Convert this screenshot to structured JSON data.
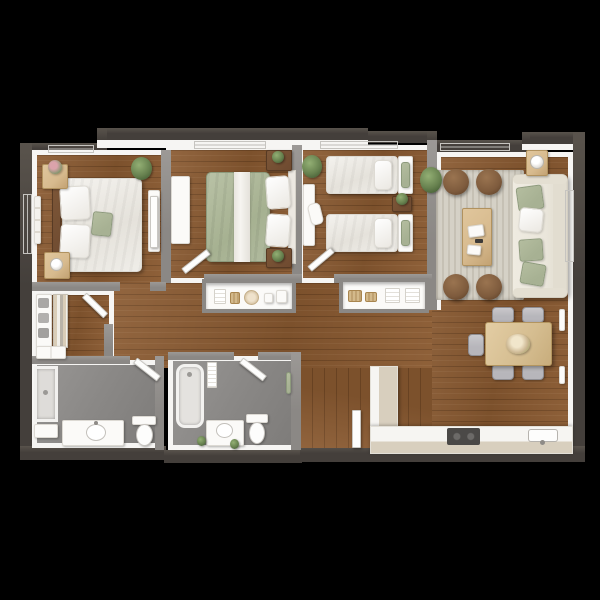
{
  "scene": {
    "type": "3d-apartment-floor-plan-render",
    "view": "top-down",
    "background": "#000000"
  },
  "palette": {
    "background": "#000000",
    "wall_exterior": "#443f3b",
    "wall_interior": "#8b8885",
    "wall_face": "#f6f5f3",
    "floor_wood": "#8a5a31",
    "floor_tile": "#8d8b89",
    "rug": "#d5d1c6",
    "sofa": "#eae6db",
    "sage": "#a7b193",
    "wood_light": "#d7ba8e",
    "wood_dark": "#6e4a30",
    "white_furniture": "#fbfaf8",
    "counter": "#d8cfbe",
    "appliance": "#4b4947",
    "ottoman": "#7e5b3d",
    "plant": "#67814f",
    "chair_gray": "#b7b6bb",
    "door_white": "#fdfdfc"
  },
  "rooms": [
    {
      "name": "bedroom-1",
      "floor": "wood",
      "furniture": [
        "double-bed",
        "headboard",
        "pillows",
        "sage-throw-pillow",
        "nightstand-with-flowers",
        "nightstand-with-lamp",
        "white-dresser",
        "potted-plant",
        "leaning-wall-art",
        "door"
      ]
    },
    {
      "name": "bedroom-2",
      "floor": "wood",
      "furniture": [
        "double-bed-sage-duvet",
        "white-bed-runner",
        "stacked-pillows",
        "dark-nightstand-with-plant-x2",
        "dresser",
        "window",
        "door"
      ]
    },
    {
      "name": "bedroom-3",
      "floor": "wood",
      "furniture": [
        "twin-bed-x2",
        "sage-headboard-cushions",
        "shared-dark-nightstand-with-plant",
        "desk",
        "desk-chair",
        "potted-plant",
        "door"
      ]
    },
    {
      "name": "living-room",
      "floor": "wood",
      "furniture": [
        "area-rug",
        "sofa-with-pillows",
        "coffee-table-with-books",
        "round-leather-ottoman-x4",
        "side-table-with-lamp",
        "potted-plant",
        "windows"
      ]
    },
    {
      "name": "dining-area",
      "floor": "wood",
      "furniture": [
        "dining-table",
        "centerpiece-flowers",
        "upholstered-chair-x5",
        "wall-art-x2"
      ]
    },
    {
      "name": "kitchen",
      "floor": "wood",
      "furniture": [
        "l-shaped-counter",
        "cooktop",
        "sink"
      ]
    },
    {
      "name": "hallway",
      "floor": "wood",
      "furniture": [
        "shelf-niche-dishes",
        "shelf-niche-linens-baskets"
      ]
    },
    {
      "name": "entry",
      "floor": "wood",
      "furniture": [
        "front-door"
      ]
    },
    {
      "name": "walk-in-closet",
      "floor": "wood",
      "furniture": [
        "shelving-with-folded-clothes",
        "hanging-clothes-rod",
        "drawer-unit",
        "door"
      ]
    },
    {
      "name": "bathroom-1",
      "floor": "tile",
      "furniture": [
        "shower",
        "vanity-with-sink",
        "toilet",
        "wall-niche",
        "door"
      ]
    },
    {
      "name": "bathroom-2",
      "floor": "tile",
      "furniture": [
        "bathtub",
        "towel-rack",
        "vanity-with-sink",
        "toilet",
        "plants",
        "sage-wall-art",
        "door"
      ]
    }
  ]
}
